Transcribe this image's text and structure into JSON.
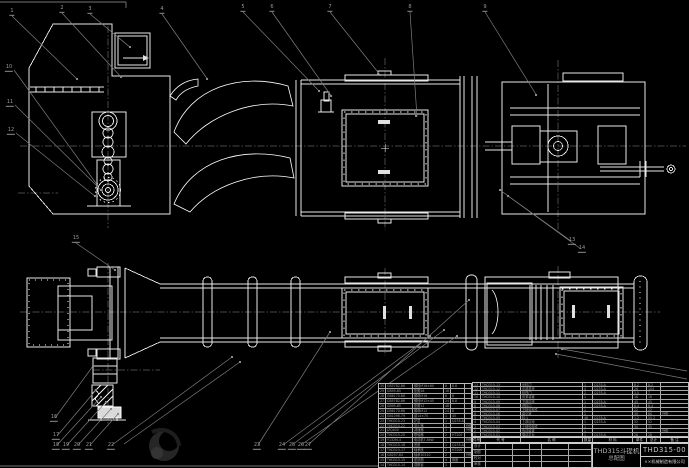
{
  "drawing": {
    "name_line1": "THD315斗提机",
    "name_line2": "总配图",
    "drawing_no": "THD315-00",
    "company": "××机械制造有限公司"
  },
  "bom_right": {
    "headers": [
      "件号",
      "代  号",
      "名  称",
      "数量",
      "材  料",
      "单件",
      "总计",
      "备 注"
    ],
    "rows": [
      [
        "13",
        "THD315-13",
        "出料口",
        "1",
        "Q235-A",
        "8.2",
        "8.2",
        ""
      ],
      [
        "12",
        "THD315-12",
        "中部机壳",
        "4",
        "Q235-A",
        "26",
        "104",
        ""
      ],
      [
        "11",
        "THD315-11",
        "检视门",
        "2",
        "Q235-A",
        "3.5",
        "7",
        ""
      ],
      [
        "10",
        "THD315-10",
        "张紧装置",
        "1",
        "",
        "18",
        "18",
        ""
      ],
      [
        "9",
        "THD315-09",
        "下部区段",
        "1",
        "Q235-A",
        "45",
        "45",
        ""
      ],
      [
        "8",
        "THD315-08",
        "进料口",
        "1",
        "Q235-A",
        "6.4",
        "6.4",
        ""
      ],
      [
        "7",
        "THD315-07",
        "下链轮部件",
        "1",
        "",
        "22",
        "22",
        ""
      ],
      [
        "6",
        "THD315-06",
        "牵引链",
        "2",
        "",
        "30",
        "60",
        "外购"
      ],
      [
        "5",
        "THD315-05",
        "料斗",
        "46",
        "Q235-A",
        "1.2",
        "55.2",
        ""
      ],
      [
        "4",
        "THD315-04",
        "上部区段",
        "1",
        "Q235-A",
        "52",
        "52",
        ""
      ],
      [
        "3",
        "THD315-03",
        "上链轮部件",
        "1",
        "",
        "35",
        "35",
        ""
      ],
      [
        "2",
        "THD315-02",
        "传动装置",
        "1",
        "",
        "",
        "",
        "外购"
      ],
      [
        "1",
        "THD315-01",
        "驱动平台",
        "1",
        "Q235-A",
        "28",
        "28",
        ""
      ]
    ]
  },
  "bom_left": {
    "rows": [
      [
        "30",
        "GB5782-86",
        "螺栓M16×60",
        "8",
        "8.8",
        ""
      ],
      [
        "29",
        "GB95-85",
        "垫圈16",
        "16",
        "",
        ""
      ],
      [
        "28",
        "GB6170-86",
        "螺母M16",
        "8",
        "8",
        ""
      ],
      [
        "27",
        "GB5782-86",
        "螺栓M12×45",
        "24",
        "8.8",
        ""
      ],
      [
        "26",
        "GB95-85",
        "垫圈12",
        "48",
        "",
        ""
      ],
      [
        "25",
        "GB6170-86",
        "螺母M12",
        "24",
        "8",
        ""
      ],
      [
        "24",
        "GB1096-79",
        "键14×70",
        "1",
        "45",
        ""
      ],
      [
        "23",
        "THD315-23",
        "护罩",
        "1",
        "Q235-A",
        ""
      ],
      [
        "22",
        "THD315-22",
        "逆止器",
        "1",
        "",
        "外购"
      ],
      [
        "21",
        "JZQ400",
        "减速器",
        "1",
        "",
        "外购"
      ],
      [
        "20",
        "THD315-20",
        "联轴器",
        "2",
        "HT200",
        ""
      ],
      [
        "19",
        "Y132M-4",
        "电动机7.5kW",
        "1",
        "",
        "外购"
      ],
      [
        "18",
        "THD315-18",
        "底座",
        "1",
        "Q235-A",
        ""
      ],
      [
        "17",
        "THD315-17",
        "轴承座",
        "2",
        "HT200",
        ""
      ],
      [
        "16",
        "GB297-84",
        "轴承30310",
        "2",
        "",
        "外购"
      ],
      [
        "15",
        "THD315-15",
        "密封圈",
        "4",
        "橡胶",
        ""
      ],
      [
        "14",
        "THD315-14",
        "观察窗",
        "1",
        "",
        ""
      ]
    ]
  },
  "titleblock": {
    "sig_labels": [
      "设计",
      "制图",
      "校对",
      "审核"
    ]
  },
  "balloons": [
    {
      "n": "1",
      "x": 12,
      "y": 13
    },
    {
      "n": "2",
      "x": 62,
      "y": 10
    },
    {
      "n": "3",
      "x": 90,
      "y": 11
    },
    {
      "n": "4",
      "x": 162,
      "y": 11
    },
    {
      "n": "5",
      "x": 243,
      "y": 9
    },
    {
      "n": "6",
      "x": 272,
      "y": 9
    },
    {
      "n": "7",
      "x": 330,
      "y": 9
    },
    {
      "n": "8",
      "x": 410,
      "y": 9
    },
    {
      "n": "9",
      "x": 485,
      "y": 9
    },
    {
      "n": "10",
      "x": 9,
      "y": 69
    },
    {
      "n": "11",
      "x": 10,
      "y": 104
    },
    {
      "n": "12",
      "x": 11,
      "y": 132
    },
    {
      "n": "13",
      "x": 572,
      "y": 242
    },
    {
      "n": "14",
      "x": 582,
      "y": 250
    },
    {
      "n": "15",
      "x": 76,
      "y": 240
    },
    {
      "n": "16",
      "x": 54,
      "y": 419
    },
    {
      "n": "17",
      "x": 56,
      "y": 437
    },
    {
      "n": "18",
      "x": 56,
      "y": 447
    },
    {
      "n": "19",
      "x": 66,
      "y": 447
    },
    {
      "n": "20",
      "x": 77,
      "y": 447
    },
    {
      "n": "21",
      "x": 89,
      "y": 447
    },
    {
      "n": "22",
      "x": 111,
      "y": 447
    },
    {
      "n": "23",
      "x": 257,
      "y": 447
    },
    {
      "n": "24",
      "x": 282,
      "y": 447
    },
    {
      "n": "25",
      "x": 292,
      "y": 447
    },
    {
      "n": "26",
      "x": 301,
      "y": 447
    },
    {
      "n": "27",
      "x": 308,
      "y": 447
    }
  ],
  "colors": {
    "background": "#000000",
    "line": "#e8e8e8",
    "leader": "#7d7d7d",
    "table_text": "#9c9c9c"
  }
}
